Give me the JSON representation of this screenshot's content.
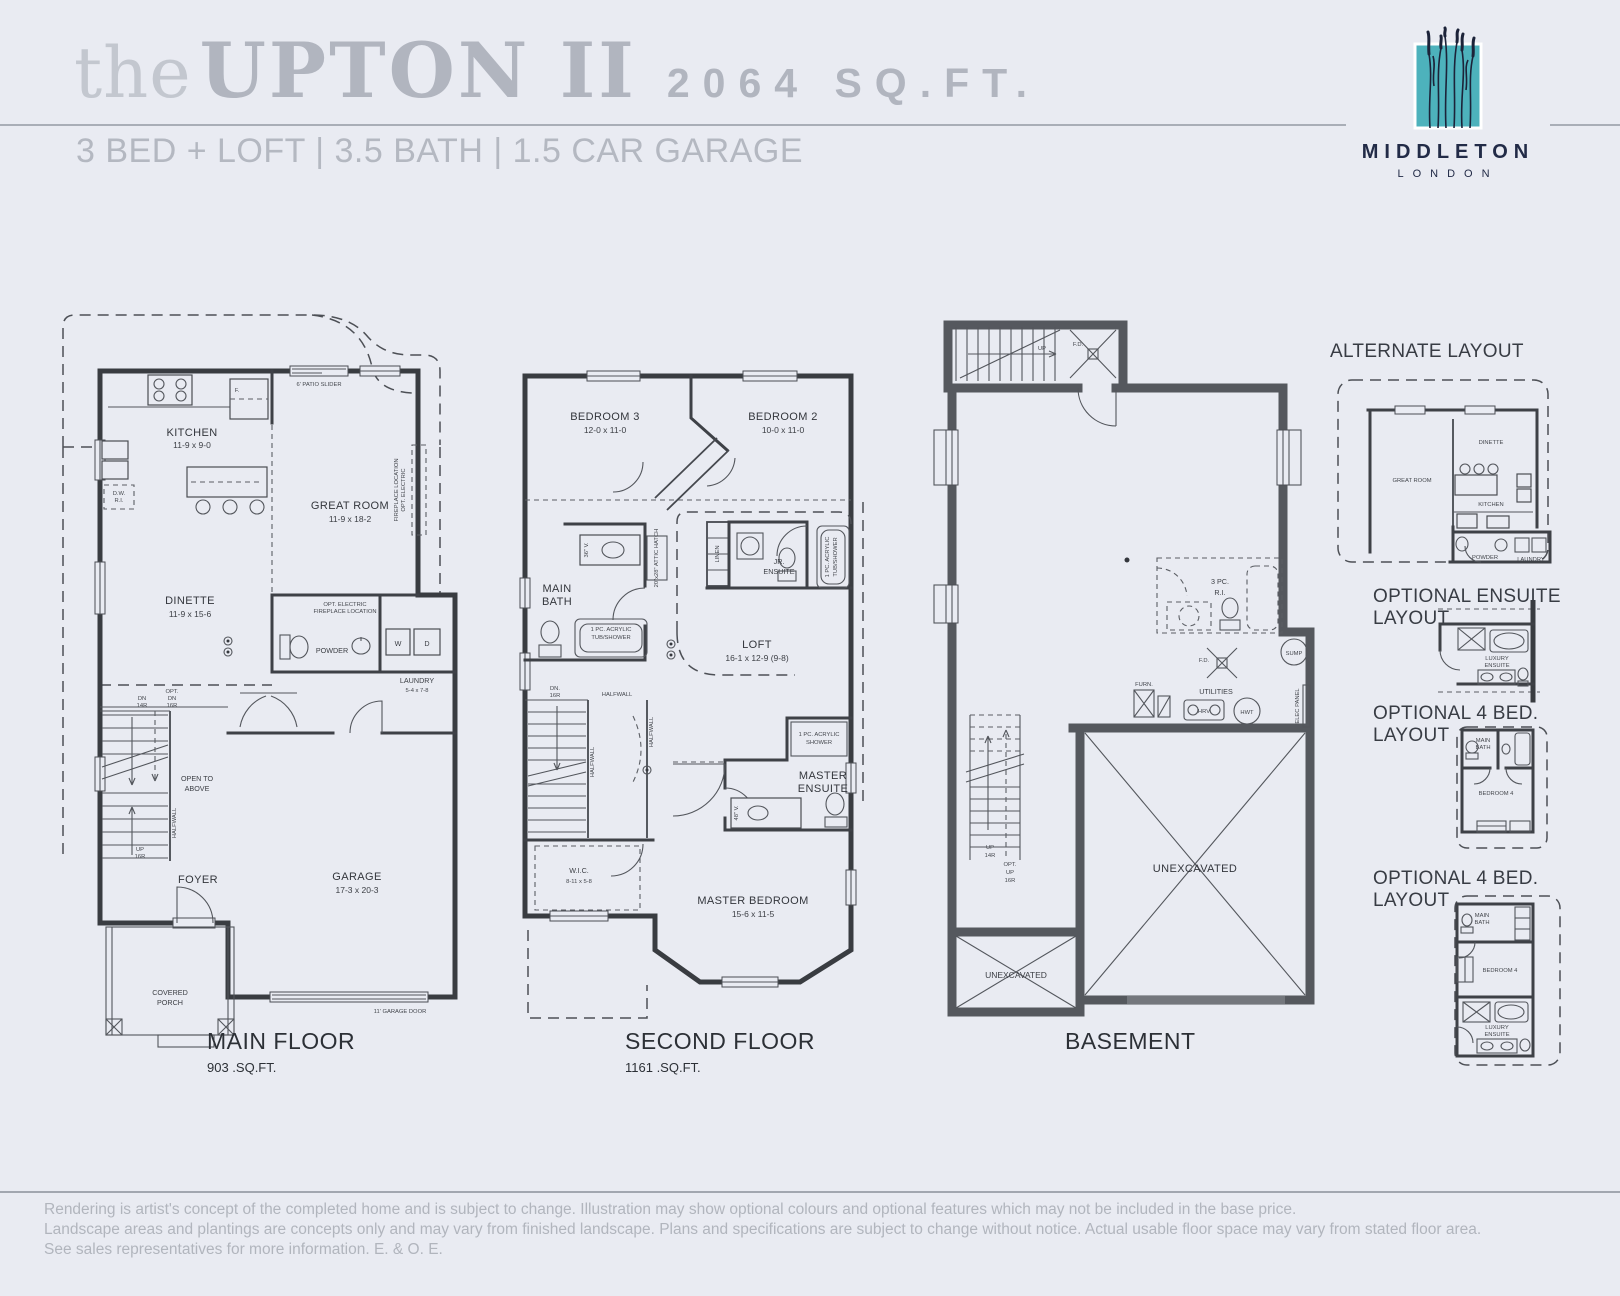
{
  "header": {
    "the": "the",
    "name": "UPTON II",
    "sqft": "2064 SQ.FT.",
    "subtitle": "3 BED + LOFT | 3.5 BATH | 1.5 CAR GARAGE"
  },
  "logo": {
    "brand": "MIDDLETON",
    "city": "LONDON",
    "teal": "#4db2bc",
    "navy": "#1c2339"
  },
  "mf": {
    "caption": "MAIN FLOOR",
    "sqft": "903 .SQ.FT.",
    "labels": {
      "kitchen": "KITCHEN",
      "kitchen_dims": "11-9 x 9-0",
      "great": "GREAT ROOM",
      "great_dims": "11-9 x 18-2",
      "dinette": "DINETTE",
      "dinette_dims": "11-9 x 15-6",
      "powder": "POWDER",
      "laundry": "LAUNDRY",
      "laundry_dims": "5-4 x 7-8",
      "foyer": "FOYER",
      "garage": "GARAGE",
      "garage_dims": "17-3 x 20-3",
      "open_a": "OPEN TO",
      "open_b": "ABOVE",
      "porch_a": "COVERED",
      "porch_b": "PORCH",
      "patio": "6' PATIO SLIDER",
      "fp_a": "OPT. ELECTRIC",
      "fp_b": "FIREPLACE LOCATION",
      "fp2_a": "OPT. ELECTRIC",
      "fp2_b": "FIREPLACE LOCATION",
      "dw_a": "D.W.",
      "dw_b": "R.I.",
      "f": "F.",
      "w": "W",
      "d": "D",
      "dn_a": "DN",
      "dn_b": "14R",
      "opt_a": "OPT.",
      "opt_b": "DN",
      "opt_c": "16R",
      "up_a": "UP",
      "up_b": "16R",
      "halfwall": "HALFWALL",
      "gdoor": "11' GARAGE DOOR"
    }
  },
  "sf": {
    "caption": "SECOND FLOOR",
    "sqft": "1161 .SQ.FT.",
    "labels": {
      "bed3": "BEDROOM 3",
      "bed3_dims": "12-0 x 11-0",
      "bed2": "BEDROOM 2",
      "bed2_dims": "10-0 x 11-0",
      "bath_a": "MAIN",
      "bath_b": "BATH",
      "linen": "LINEN",
      "jr_a": "JR.",
      "jr_b": "ENSUITE",
      "tub1_a": "1 PC. ACRYLIC",
      "tub1_b": "TUB/SHOWER",
      "tub2_a": "1 PC. ACRYLIC",
      "tub2_b": "TUB/SHOWER",
      "attic": "20\"x28\" ATTIC HATCH",
      "loft": "LOFT",
      "loft_dims": "16-1 x 12-9 (9-8)",
      "dn_a": "DN.",
      "dn_b": "16R",
      "hw1": "HALFWALL",
      "hw2": "HALFWALL",
      "hw3": "HALFWALL",
      "shower_a": "1 PC. ACRYLIC",
      "shower_b": "SHOWER",
      "me_a": "MASTER",
      "me_b": "ENSUITE",
      "v36": "36\" V.",
      "v48": "48\" V.",
      "wic": "W.I.C.",
      "wic_dims": "8-11 x 5-8",
      "master": "MASTER BEDROOM",
      "master_dims": "15-6 x 11-5"
    }
  },
  "bs": {
    "caption": "BASEMENT",
    "labels": {
      "up": "UP",
      "fd1": "F.D.",
      "fd2": "F.D.",
      "pc_a": "3 PC.",
      "pc_b": "R.I.",
      "sump": "SUMP",
      "furn": "FURN.",
      "utilities": "UTILITIES",
      "hrv": "HRV",
      "hwt": "HWT",
      "elec": "ELEC PANEL",
      "up14_a": "UP",
      "up14_b": "14R",
      "opt_a": "OPT.",
      "opt_b": "UP",
      "opt_c": "16R",
      "unex1": "UNEXCAVATED",
      "unex2": "UNEXCAVATED"
    }
  },
  "side": {
    "alt": {
      "heading": "ALTERNATE LAYOUT",
      "great": "GREAT ROOM",
      "dinette": "DINETTE",
      "kitchen": "KITCHEN",
      "powder": "POWDER",
      "laundry": "LAUNDRY"
    },
    "ens": {
      "heading": "OPTIONAL ENSUITE LAYOUT",
      "lux_a": "LUXURY",
      "lux_b": "ENSUITE"
    },
    "b4a": {
      "heading": "OPTIONAL 4 BED. LAYOUT",
      "bath_a": "MAIN",
      "bath_b": "BATH",
      "bed": "BEDROOM 4"
    },
    "b4b": {
      "heading": "OPTIONAL 4 BED. LAYOUT",
      "bath_a": "MAIN",
      "bath_b": "BATH",
      "bed": "BEDROOM 4",
      "lux_a": "LUXURY",
      "lux_b": "ENSUITE"
    }
  },
  "disclaimer": {
    "l1": "Rendering is artist's concept of the completed home and is subject to change. Illustration may show optional colours and optional features which may not be included in the base price.",
    "l2": "Landscape areas and plantings are concepts only and may vary from finished landscape. Plans and specifications are subject to change without notice. Actual usable floor space may vary from stated floor area.",
    "l3": "See sales representatives for more information. E. & O. E."
  }
}
